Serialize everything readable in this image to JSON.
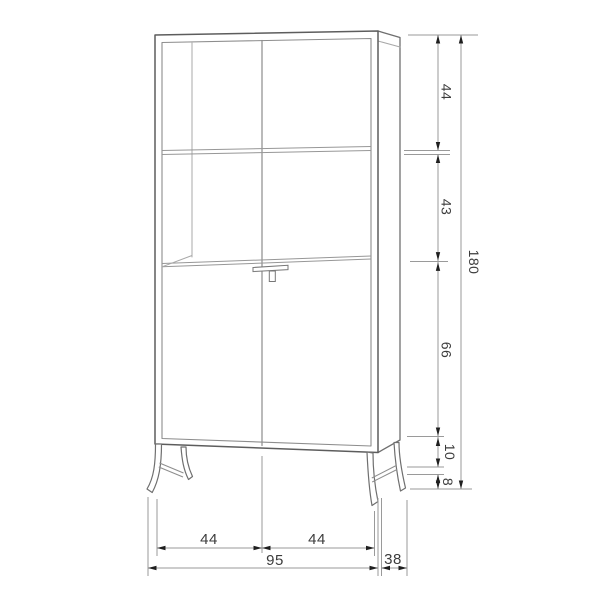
{
  "diagram": {
    "kind": "furniture-dimension-drawing",
    "subject": "tall display cabinet, three-quarter view with shelves, drop-front desk handle and splayed legs",
    "colors": {
      "background": "#ffffff",
      "outline_dark": "#5d5d5d",
      "outline_mid": "#8d8d8d",
      "outline_light": "#a8a8a8",
      "dimension_line": "#9a9a9a",
      "arrow": "#1f1f1f",
      "text": "#3c3c3c"
    }
  },
  "dims": {
    "top_section": "44",
    "middle_section": "43",
    "door_section": "66",
    "base_clearance": "10",
    "foot_height": "8",
    "total_height": "180",
    "bottom_left_half": "44",
    "bottom_right_half": "44",
    "total_width": "95",
    "depth": "38"
  }
}
